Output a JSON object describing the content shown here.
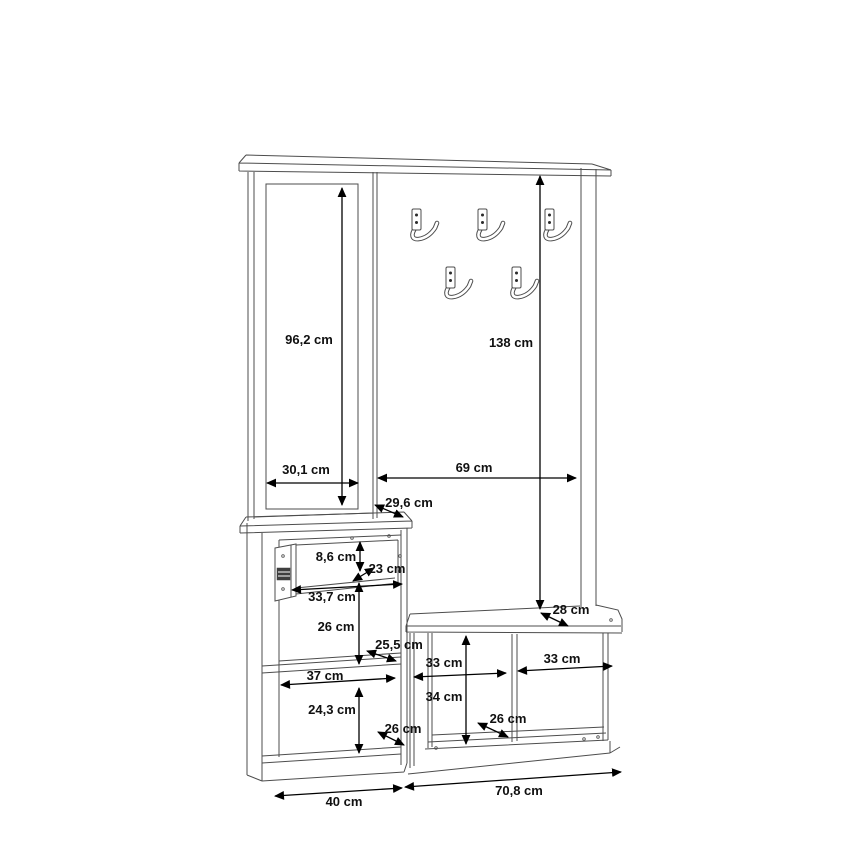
{
  "document": {
    "type": "furniture-dimension-drawing",
    "subject": "hallway wardrobe unit with mirror, coat hook panel, drawer cabinet and shoe bench",
    "unit": "cm"
  },
  "colors": {
    "background": "#ffffff",
    "outline": "#4d4d4d",
    "dimension_line": "#000000",
    "label_text": "#101010"
  },
  "hooks": {
    "icon": "coat-hook-icon",
    "count": 5,
    "positions": [
      [
        412,
        209
      ],
      [
        478,
        209
      ],
      [
        545,
        209
      ],
      [
        446,
        267
      ],
      [
        512,
        267
      ]
    ]
  },
  "screw_holes": [
    [
      352,
      538
    ],
    [
      389,
      536
    ],
    [
      400,
      556
    ],
    [
      400,
      571
    ],
    [
      611,
      620
    ],
    [
      584,
      739
    ],
    [
      598,
      737
    ],
    [
      436,
      748
    ]
  ],
  "dimensions": [
    {
      "id": "mirror-height",
      "label": "96,2 cm",
      "value_cm": 96.2,
      "x1": 342,
      "y1": 188,
      "x2": 342,
      "y2": 505,
      "lx": 309,
      "ly": 344
    },
    {
      "id": "coat-panel-height",
      "label": "138 cm",
      "value_cm": 138,
      "x1": 540,
      "y1": 176,
      "x2": 540,
      "y2": 609,
      "lx": 511,
      "ly": 347
    },
    {
      "id": "mirror-width",
      "label": "30,1 cm",
      "value_cm": 30.1,
      "x1": 267,
      "y1": 483,
      "x2": 358,
      "y2": 483,
      "lx": 306,
      "ly": 474
    },
    {
      "id": "coat-panel-width",
      "label": "69 cm",
      "value_cm": 69,
      "x1": 378,
      "y1": 478,
      "x2": 576,
      "y2": 478,
      "lx": 474,
      "ly": 472
    },
    {
      "id": "cabinet-top-depth",
      "label": "29,6 cm",
      "value_cm": 29.6,
      "x1": 375,
      "y1": 505,
      "x2": 403,
      "y2": 517,
      "lx": 409,
      "ly": 507
    },
    {
      "id": "drawer-height",
      "label": "8,6 cm",
      "value_cm": 8.6,
      "x1": 360,
      "y1": 542,
      "x2": 360,
      "y2": 571,
      "lx": 336,
      "ly": 561
    },
    {
      "id": "drawer-depth",
      "label": "23 cm",
      "value_cm": 23,
      "x1": 353,
      "y1": 581,
      "x2": 374,
      "y2": 568,
      "lx": 387,
      "ly": 573
    },
    {
      "id": "drawer-width",
      "label": "33,7 cm",
      "value_cm": 33.7,
      "x1": 292,
      "y1": 590,
      "x2": 402,
      "y2": 584,
      "lx": 332,
      "ly": 601
    },
    {
      "id": "upper-compartment-height",
      "label": "26 cm",
      "value_cm": 26,
      "x1": 359,
      "y1": 583,
      "x2": 359,
      "y2": 664,
      "lx": 336,
      "ly": 631
    },
    {
      "id": "shelf-depth",
      "label": "25,5 cm",
      "value_cm": 25.5,
      "x1": 367,
      "y1": 651,
      "x2": 396,
      "y2": 661,
      "lx": 399,
      "ly": 649
    },
    {
      "id": "cabinet-inner-width",
      "label": "37 cm",
      "value_cm": 37,
      "x1": 281,
      "y1": 685,
      "x2": 395,
      "y2": 678,
      "lx": 325,
      "ly": 680
    },
    {
      "id": "lower-compartment-height",
      "label": "24,3 cm",
      "value_cm": 24.3,
      "x1": 359,
      "y1": 688,
      "x2": 359,
      "y2": 753,
      "lx": 332,
      "ly": 714
    },
    {
      "id": "cabinet-bottom-depth",
      "label": "26 cm",
      "value_cm": 26,
      "x1": 378,
      "y1": 732,
      "x2": 404,
      "y2": 745,
      "lx": 403,
      "ly": 733
    },
    {
      "id": "bench-top-depth",
      "label": "28 cm",
      "value_cm": 28,
      "x1": 541,
      "y1": 613,
      "x2": 568,
      "y2": 626,
      "lx": 571,
      "ly": 614
    },
    {
      "id": "bench-left-compartment-width",
      "label": "33 cm",
      "value_cm": 33,
      "x1": 414,
      "y1": 677,
      "x2": 506,
      "y2": 673,
      "lx": 444,
      "ly": 667
    },
    {
      "id": "bench-right-compartment-width",
      "label": "33 cm",
      "value_cm": 33,
      "x1": 518,
      "y1": 671,
      "x2": 612,
      "y2": 666,
      "lx": 562,
      "ly": 663
    },
    {
      "id": "bench-compartment-height",
      "label": "34 cm",
      "value_cm": 34,
      "x1": 466,
      "y1": 636,
      "x2": 466,
      "y2": 744,
      "lx": 444,
      "ly": 701
    },
    {
      "id": "bench-bottom-depth",
      "label": "26 cm",
      "value_cm": 26,
      "x1": 478,
      "y1": 723,
      "x2": 508,
      "y2": 737,
      "lx": 508,
      "ly": 723
    },
    {
      "id": "cabinet-width",
      "label": "40 cm",
      "value_cm": 40,
      "x1": 275,
      "y1": 796,
      "x2": 402,
      "y2": 788,
      "lx": 344,
      "ly": 806
    },
    {
      "id": "bench-width",
      "label": "70,8 cm",
      "value_cm": 70.8,
      "x1": 405,
      "y1": 787,
      "x2": 621,
      "y2": 772,
      "lx": 519,
      "ly": 795
    }
  ]
}
